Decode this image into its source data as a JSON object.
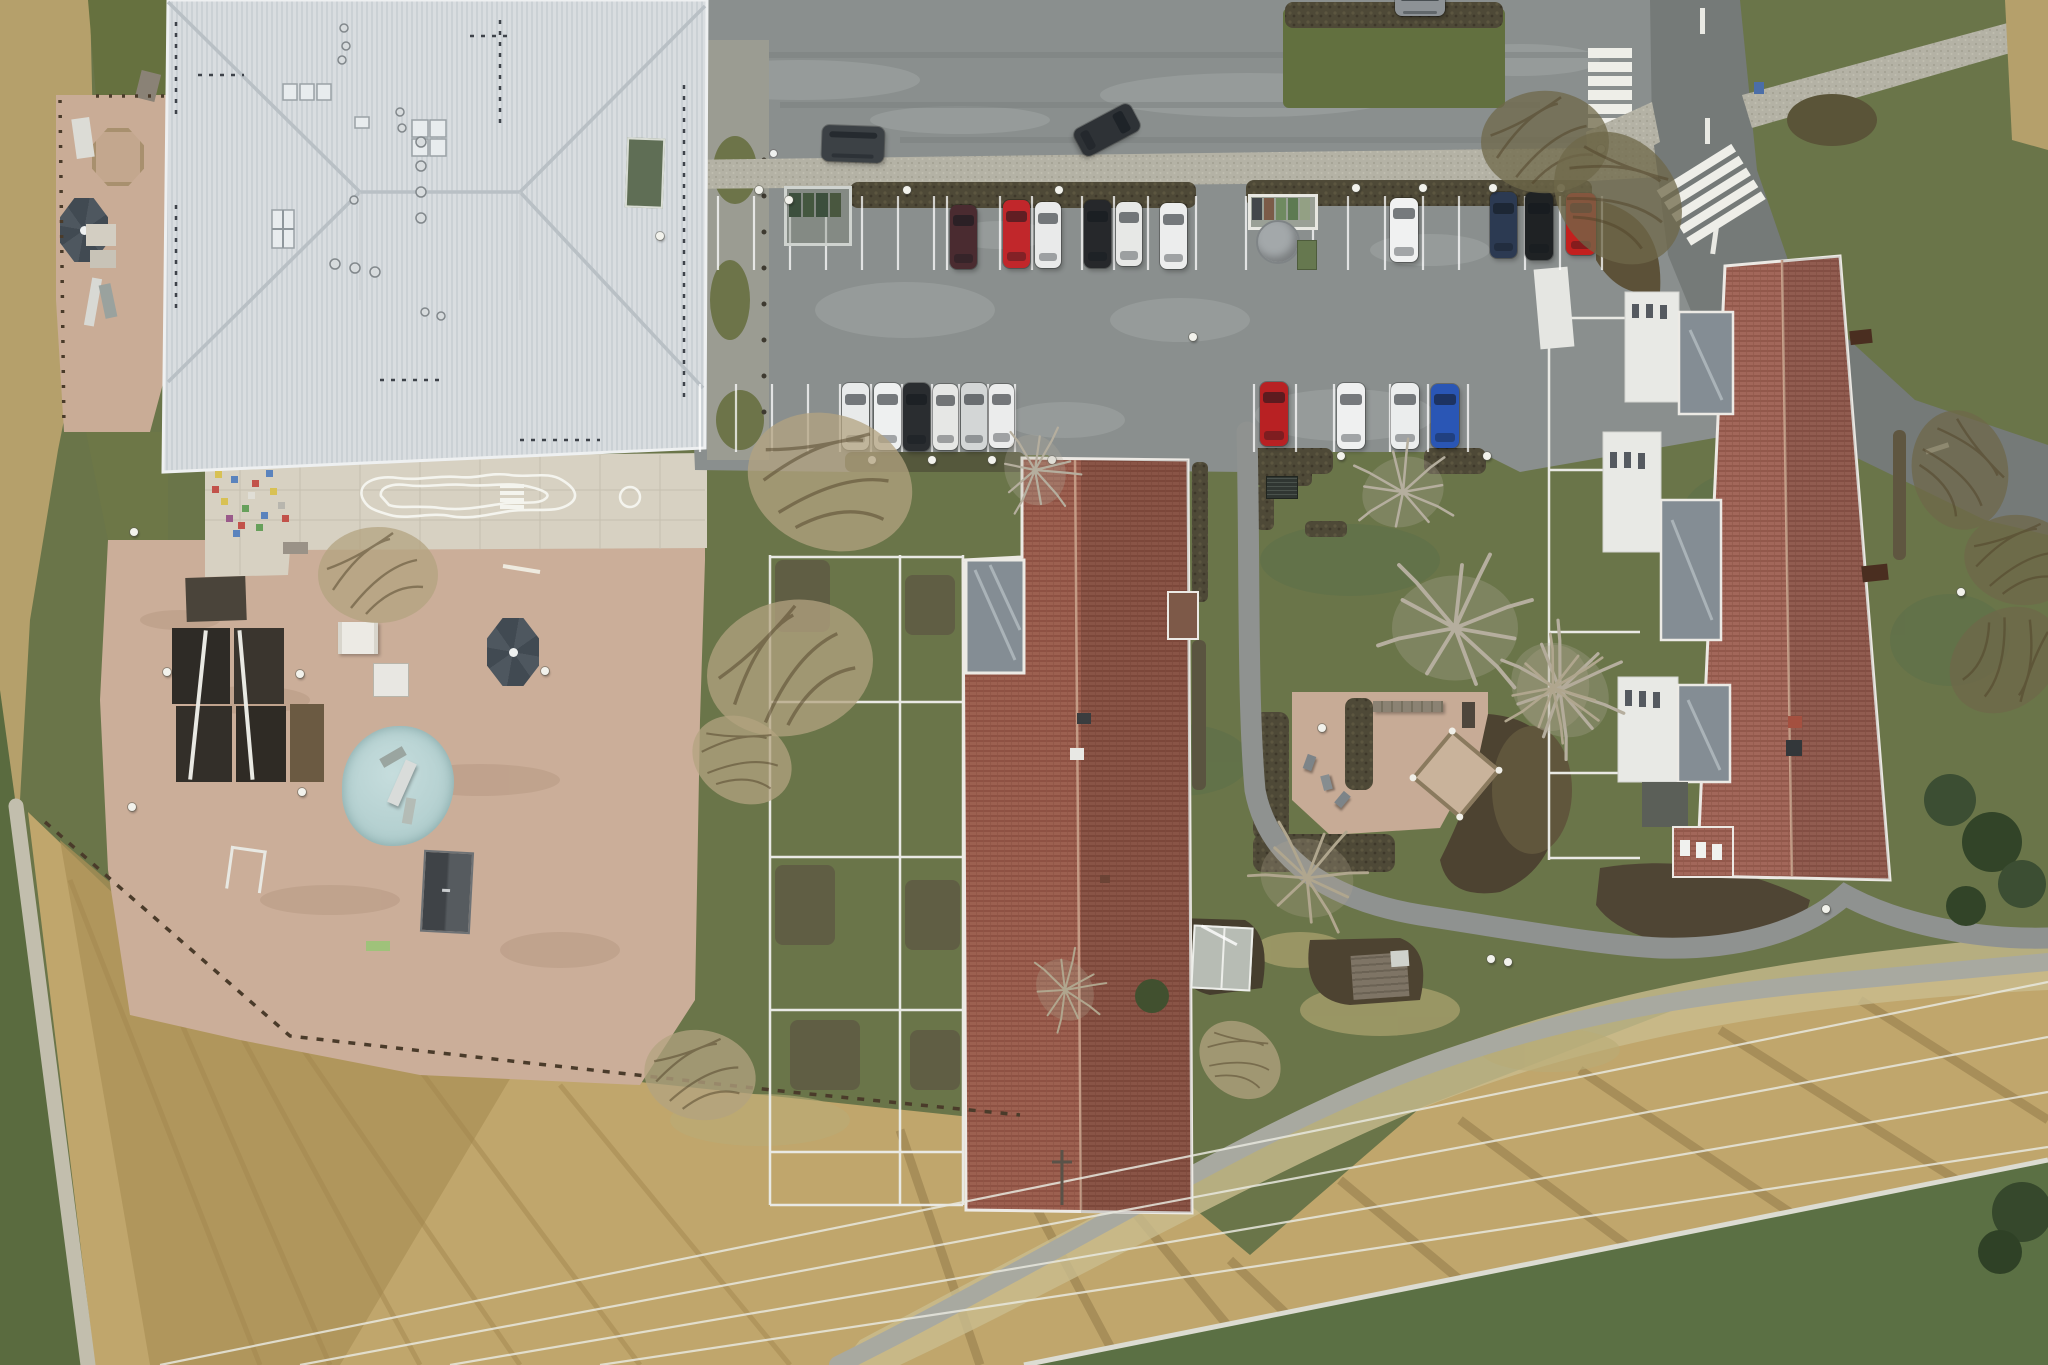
{
  "scene": {
    "description": "Top-down aerial drone photo of a residential block in winter: a large building with a pale grey metal hip roof and a sandy playground (school/kindergarten) on the left, a car park with two rows of parked cars at top centre, two long apartment buildings with red-brown tiled roofs, a courtyard play area with hedges and bare trees, a road with two zebra crossings at top right, and dry tan meadows crossed by footpaths and power lines at the bottom."
  },
  "colors": {
    "grass": "#6a7549",
    "grass_dark": "#5c6b41",
    "grass_bright": "#5f7042",
    "field_tan": "#c0a66c",
    "field_streak": "#a3874f",
    "field_dark": "#8a7244",
    "pale_band": "#c9bd8e",
    "sand": "#cbae99",
    "sand_north": "#c9ac96",
    "patio": "#d7d1c2",
    "asphalt_parking": "#8a8f8e",
    "asphalt_access": "#979c9a",
    "road_dark": "#757a78",
    "cobble": "#b4b2a5",
    "hedge_brown": "#4e4937",
    "hedge_dark": "#463e2e",
    "roof_metal": "#d9dde0",
    "roof_metal_stripe": "#cbd1d5",
    "roof_ridge": "#b9c0c5",
    "roof_tile": "#9c6050",
    "roof_tile_line": "#86493c",
    "eave_white": "#ece9e4",
    "canopy_glass": "#848d94",
    "facade_white": "#e8e9e5",
    "pond_blue": "#b7d2d2",
    "umbrella_grey": "#49525a",
    "marking_white": "#f2f2ee"
  },
  "objects": {
    "cars": [
      {
        "x": 950,
        "y": 205,
        "w": 27,
        "h": 64,
        "c": "#4a2b30"
      },
      {
        "x": 1003,
        "y": 200,
        "w": 27,
        "h": 68,
        "c": "#c1272b"
      },
      {
        "x": 1035,
        "y": 202,
        "w": 26,
        "h": 66,
        "c": "#e9eaea"
      },
      {
        "x": 1084,
        "y": 200,
        "w": 27,
        "h": 68,
        "c": "#26282b"
      },
      {
        "x": 1116,
        "y": 202,
        "w": 26,
        "h": 64,
        "c": "#e7e8e6"
      },
      {
        "x": 1160,
        "y": 203,
        "w": 27,
        "h": 66,
        "c": "#eceded"
      },
      {
        "x": 1390,
        "y": 198,
        "w": 28,
        "h": 64,
        "c": "#f0f1f1"
      },
      {
        "x": 1490,
        "y": 192,
        "w": 27,
        "h": 66,
        "c": "#2c3a52"
      },
      {
        "x": 1525,
        "y": 192,
        "w": 28,
        "h": 68,
        "c": "#1f2224"
      },
      {
        "x": 1566,
        "y": 193,
        "w": 30,
        "h": 62,
        "c": "#c3201e"
      },
      {
        "x": 842,
        "y": 383,
        "w": 27,
        "h": 67,
        "c": "#e8eaea"
      },
      {
        "x": 874,
        "y": 383,
        "w": 27,
        "h": 67,
        "c": "#eef0f0"
      },
      {
        "x": 903,
        "y": 383,
        "w": 27,
        "h": 68,
        "c": "#2a2d30"
      },
      {
        "x": 933,
        "y": 384,
        "w": 25,
        "h": 66,
        "c": "#e6e7e5"
      },
      {
        "x": 961,
        "y": 383,
        "w": 26,
        "h": 67,
        "c": "#d3d6d6"
      },
      {
        "x": 989,
        "y": 384,
        "w": 25,
        "h": 64,
        "c": "#ebecec"
      },
      {
        "x": 1260,
        "y": 382,
        "w": 28,
        "h": 64,
        "c": "#b82123"
      },
      {
        "x": 1337,
        "y": 383,
        "w": 28,
        "h": 66,
        "c": "#eff0f0"
      },
      {
        "x": 1391,
        "y": 383,
        "w": 28,
        "h": 66,
        "c": "#ebeded"
      },
      {
        "x": 1431,
        "y": 384,
        "w": 28,
        "h": 64,
        "c": "#2a56b5"
      },
      {
        "x": 822,
        "y": 126,
        "w": 62,
        "h": 36,
        "c": "#3c4145",
        "r": 2
      },
      {
        "x": 1092,
        "y": 98,
        "w": 30,
        "h": 64,
        "c": "#2e3236",
        "r": 62
      },
      {
        "x": 1395,
        "y": -6,
        "w": 50,
        "h": 22,
        "c": "#8d9296",
        "r": 0
      }
    ],
    "lamps": [
      {
        "x": 755,
        "y": 186
      },
      {
        "x": 903,
        "y": 186
      },
      {
        "x": 1055,
        "y": 186
      },
      {
        "x": 1352,
        "y": 184
      },
      {
        "x": 1419,
        "y": 184
      },
      {
        "x": 1489,
        "y": 184
      },
      {
        "x": 1557,
        "y": 184
      },
      {
        "x": 868,
        "y": 456
      },
      {
        "x": 928,
        "y": 456
      },
      {
        "x": 988,
        "y": 456
      },
      {
        "x": 1048,
        "y": 456
      },
      {
        "x": 1337,
        "y": 452
      },
      {
        "x": 1483,
        "y": 452
      },
      {
        "x": 1318,
        "y": 724
      },
      {
        "x": 1504,
        "y": 958
      },
      {
        "x": 1957,
        "y": 588
      },
      {
        "x": 1189,
        "y": 333
      },
      {
        "x": 656,
        "y": 232
      },
      {
        "x": 1597,
        "y": 145
      },
      {
        "x": 785,
        "y": 196
      },
      {
        "x": 1822,
        "y": 905
      },
      {
        "x": 130,
        "y": 528
      },
      {
        "x": 163,
        "y": 668
      },
      {
        "x": 296,
        "y": 670
      },
      {
        "x": 298,
        "y": 788
      },
      {
        "x": 128,
        "y": 803
      },
      {
        "x": 541,
        "y": 667
      },
      {
        "x": 1487,
        "y": 955
      }
    ],
    "stall_lines": {
      "row1": {
        "y1": 196,
        "y2": 270,
        "xs": [
          718,
          754,
          790,
          826,
          862,
          898,
          934,
          947,
          1000,
          1032,
          1082,
          1114,
          1148,
          1196,
          1246,
          1313,
          1348,
          1385,
          1423,
          1459,
          1525,
          1560,
          1602
        ]
      },
      "row2": {
        "y1": 384,
        "y2": 452,
        "xs": [
          700,
          736,
          772,
          808,
          840,
          871,
          902,
          932,
          959,
          988,
          1015,
          1254,
          1296,
          1334,
          1390,
          1428,
          1468
        ]
      }
    },
    "mosaic": [
      {
        "x": 212,
        "y": 486,
        "c": "#c2524a"
      },
      {
        "x": 221,
        "y": 498,
        "c": "#d8c154"
      },
      {
        "x": 231,
        "y": 476,
        "c": "#5a83bd"
      },
      {
        "x": 242,
        "y": 505,
        "c": "#67a05b"
      },
      {
        "x": 252,
        "y": 480,
        "c": "#c2524a"
      },
      {
        "x": 261,
        "y": 512,
        "c": "#5a83bd"
      },
      {
        "x": 270,
        "y": 488,
        "c": "#d8c154"
      },
      {
        "x": 278,
        "y": 502,
        "c": "#b8b6ae"
      },
      {
        "x": 226,
        "y": 515,
        "c": "#9a5a8a"
      },
      {
        "x": 238,
        "y": 522,
        "c": "#c2524a"
      },
      {
        "x": 256,
        "y": 524,
        "c": "#67a05b"
      },
      {
        "x": 215,
        "y": 471,
        "c": "#d8c154"
      },
      {
        "x": 266,
        "y": 470,
        "c": "#5a83bd"
      },
      {
        "x": 282,
        "y": 515,
        "c": "#c2524a"
      },
      {
        "x": 248,
        "y": 492,
        "c": "#e0ded6"
      },
      {
        "x": 233,
        "y": 530,
        "c": "#5a83bd"
      }
    ],
    "recycling_bins": [
      "#43474b",
      "#7b5b48",
      "#6f8a60",
      "#5d7a52",
      "#93a084"
    ]
  }
}
